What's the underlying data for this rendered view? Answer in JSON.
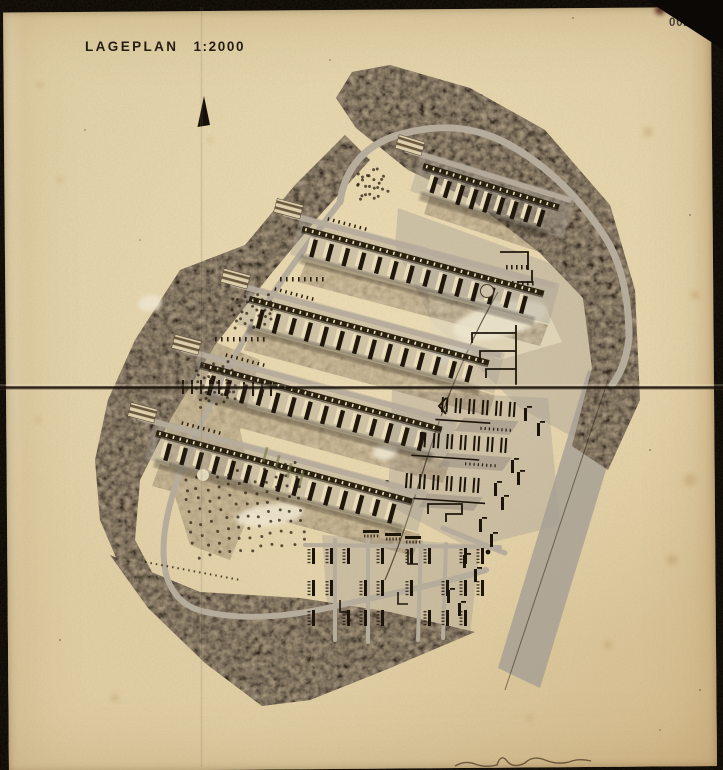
{
  "document": {
    "title": "LAGEPLAN",
    "scale": "1:2000",
    "page_number": "0026"
  },
  "icons": {
    "north_arrow": "triangle-up"
  },
  "colors": {
    "frame": "#0b0703",
    "paper": "#e3d1a6",
    "paper_edge": "#d3bd8d",
    "ink": "#241d12",
    "page_number_ink": "#45403a",
    "forest": "#33261a",
    "forest_speckle": "#8c7352",
    "road": "#b6ac9b",
    "ground_gray": "#a49d93",
    "building_dark": "#1f160c",
    "building_light": "#e9dcb9",
    "pond": "#ece3cc",
    "accent_green": "#6e7040",
    "foxing": "#96682e"
  }
}
